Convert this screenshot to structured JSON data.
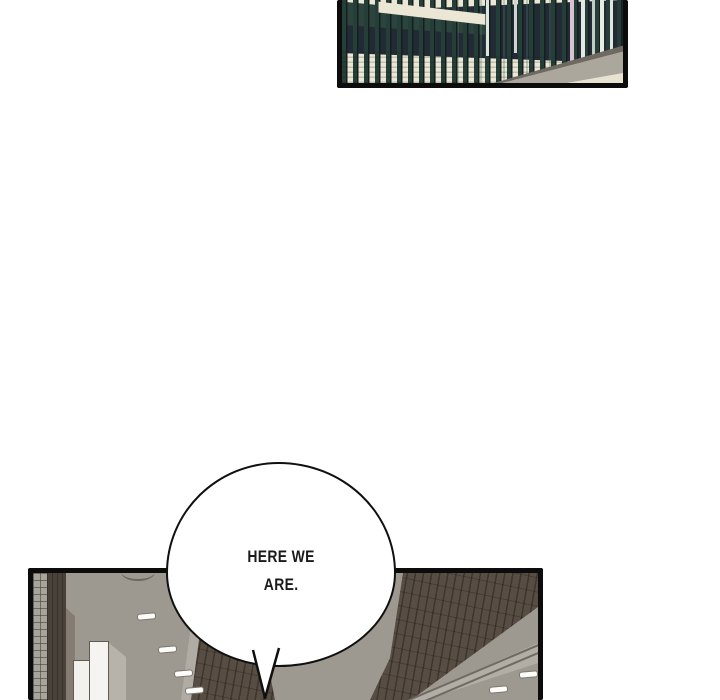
{
  "comic": {
    "speech_bubble": {
      "line1": "HERE WE",
      "line2": "ARE.",
      "full_text": "HERE WE ARE."
    },
    "panel_top": {
      "alt": "Dark green metal fence railing seen at an angle"
    },
    "panel_bottom": {
      "alt": "Looking up at a grey ceiling with recessed lights, brick beams and white pillars"
    },
    "colors": {
      "ink": "#0c0c0c",
      "paper": "#ffffff",
      "fence_teal": "#263e38",
      "fence_navy": "#222a36",
      "cream": "#ece7d5",
      "ceiling_gray": "#9e9990",
      "brick_brown": "#574d43"
    }
  }
}
